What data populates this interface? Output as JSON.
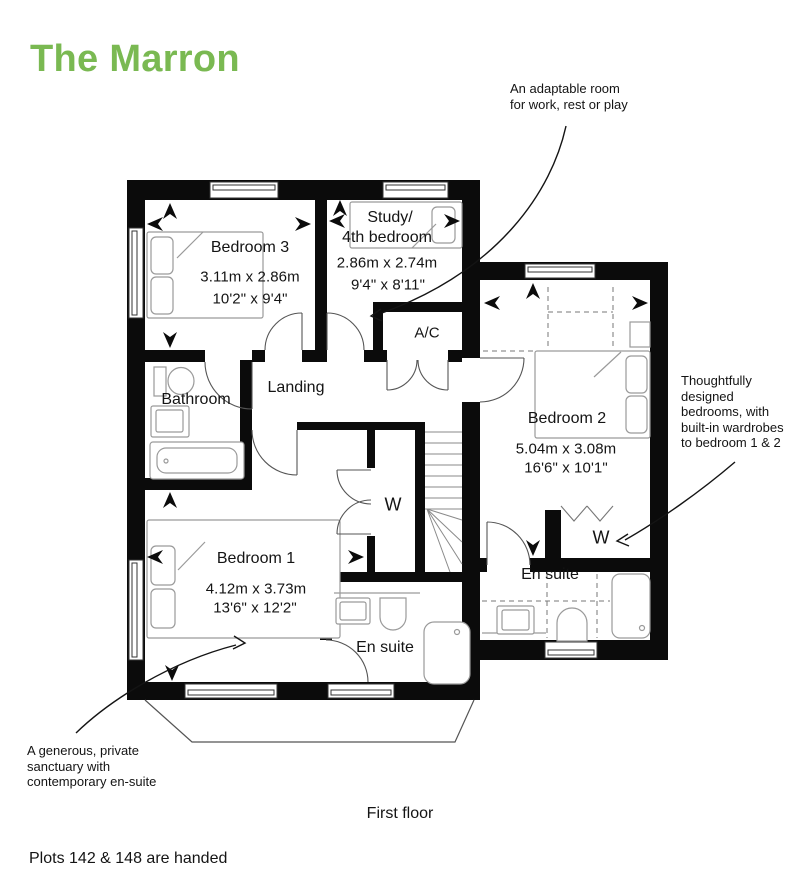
{
  "title": "The Marron",
  "accent_color": "#7ab952",
  "floor_label": "First floor",
  "footnote": "Plots 142 & 148 are handed",
  "annotations": {
    "study": {
      "lines": [
        "An adaptable room",
        "for work, rest or play"
      ]
    },
    "wardrobes": {
      "lines": [
        "Thoughtfully",
        "designed",
        "bedrooms, with",
        "built-in wardrobes",
        "to bedroom 1 & 2"
      ]
    },
    "master": {
      "lines": [
        "A generous, private",
        "sanctuary with",
        "contemporary en-suite"
      ]
    }
  },
  "rooms": {
    "bedroom3": {
      "name": "Bedroom 3",
      "metric": "3.11m x 2.86m",
      "imperial": "10'2\" x 9'4\""
    },
    "study": {
      "name_line1": "Study/",
      "name_line2": "4th bedroom",
      "metric": "2.86m x 2.74m",
      "imperial": "9'4\" x 8'11\""
    },
    "ac": {
      "name": "A/C"
    },
    "landing": {
      "name": "Landing"
    },
    "bathroom": {
      "name": "Bathroom"
    },
    "bedroom2": {
      "name": "Bedroom 2",
      "metric": "5.04m x 3.08m",
      "imperial": "16'6\" x 10'1\""
    },
    "bedroom1": {
      "name": "Bedroom 1",
      "metric": "4.12m x 3.73m",
      "imperial": "13'6\" x 12'2\""
    },
    "ensuite1": {
      "name": "En suite"
    },
    "ensuite2": {
      "name": "En suite"
    },
    "wardrobe1": {
      "name": "W"
    },
    "wardrobe2": {
      "name": "W"
    }
  }
}
